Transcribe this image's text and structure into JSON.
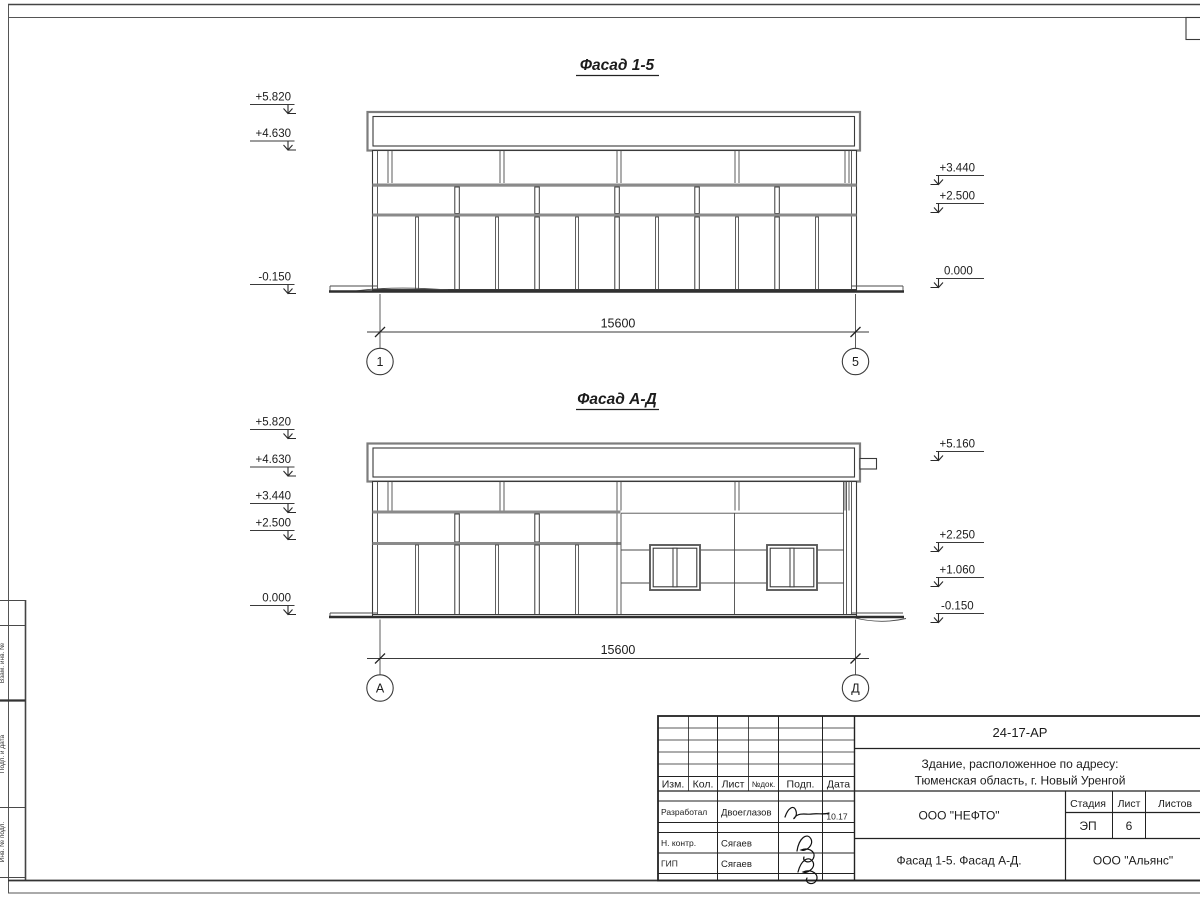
{
  "facade_1_5": {
    "title": "Фасад 1-5",
    "left_marks": [
      "+5.820",
      "+4.630",
      "-0.150"
    ],
    "right_marks": [
      "+3.440",
      "+2.500",
      "0.000"
    ],
    "dimension": "15600",
    "axis_left": "1",
    "axis_right": "5"
  },
  "facade_a_d": {
    "title": "Фасад А-Д",
    "left_marks": [
      "+5.820",
      "+4.630",
      "+3.440",
      "+2.500",
      "0.000"
    ],
    "right_marks": [
      "+5.160",
      "+2.250",
      "+1.060",
      "-0.150"
    ],
    "dimension": "15600",
    "axis_left": "А",
    "axis_right": "Д"
  },
  "title_block": {
    "doc_number": "24-17-АР",
    "project_line1": "Здание, расположенное по адресу:",
    "project_line2": "Тюменская область, г. Новый Уренгой",
    "rev_headers": {
      "izm": "Изм.",
      "kol": "Кол.",
      "list": "Лист",
      "ndok": "№док.",
      "podp": "Подп.",
      "data": "Дата"
    },
    "rows": [
      {
        "role": "Разработал",
        "name": "Двоеглазов",
        "date": "10.17"
      },
      {
        "role": "Н. контр.",
        "name": "Сягаев"
      },
      {
        "role": "ГИП",
        "name": "Сягаев"
      }
    ],
    "org1": "ООО \"НЕФТО\"",
    "stage_label": "Стадия",
    "sheet_label": "Лист",
    "sheets_label": "Листов",
    "stage": "ЭП",
    "sheet_num": "6",
    "drawing_title": "Фасад 1-5. Фасад А-Д.",
    "org2": "ООО \"Альянс\""
  },
  "frame_labels": {
    "vzam": "Взам. инв. №",
    "podp_data": "Подп. и дата",
    "inv_podl": "Инв. № подл."
  }
}
